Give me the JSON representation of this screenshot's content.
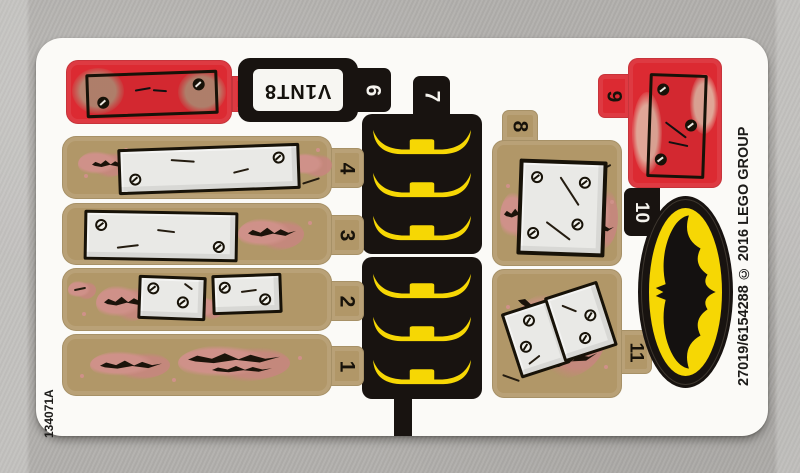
{
  "meta": {
    "sheet_code": "134071A",
    "copyright_text": "27019/6154288 © 2016 LEGO GROUP"
  },
  "colors": {
    "background": "#b2b0ad",
    "sheet": "#fbfaf7",
    "red": "#dc2a32",
    "black": "#181310",
    "tan": "#b19768",
    "yellow": "#f6d704",
    "pink": "#cf9189",
    "plank": "#e9e9e6",
    "plate": "#f7f6f2"
  },
  "stickers": [
    {
      "label": "1",
      "type": "tan strip with claw scratches"
    },
    {
      "label": "2",
      "type": "tan strip with two wood planks"
    },
    {
      "label": "3",
      "type": "tan strip with long wood plank"
    },
    {
      "label": "4",
      "type": "tan strip with long wood plank"
    },
    {
      "label": "5",
      "type": "red panel with boarded plank"
    },
    {
      "label": "6",
      "type": "upside-down license plate",
      "plate_text": "V1NT8"
    },
    {
      "label": "7",
      "type": "black panels with yellow bat rails"
    },
    {
      "label": "8",
      "type": "tan square with wood plank"
    },
    {
      "label": "9",
      "type": "red panel with vertical plank"
    },
    {
      "label": "10",
      "type": "Batman logo oval"
    },
    {
      "label": "11",
      "type": "tan square with tilted planks"
    }
  ]
}
